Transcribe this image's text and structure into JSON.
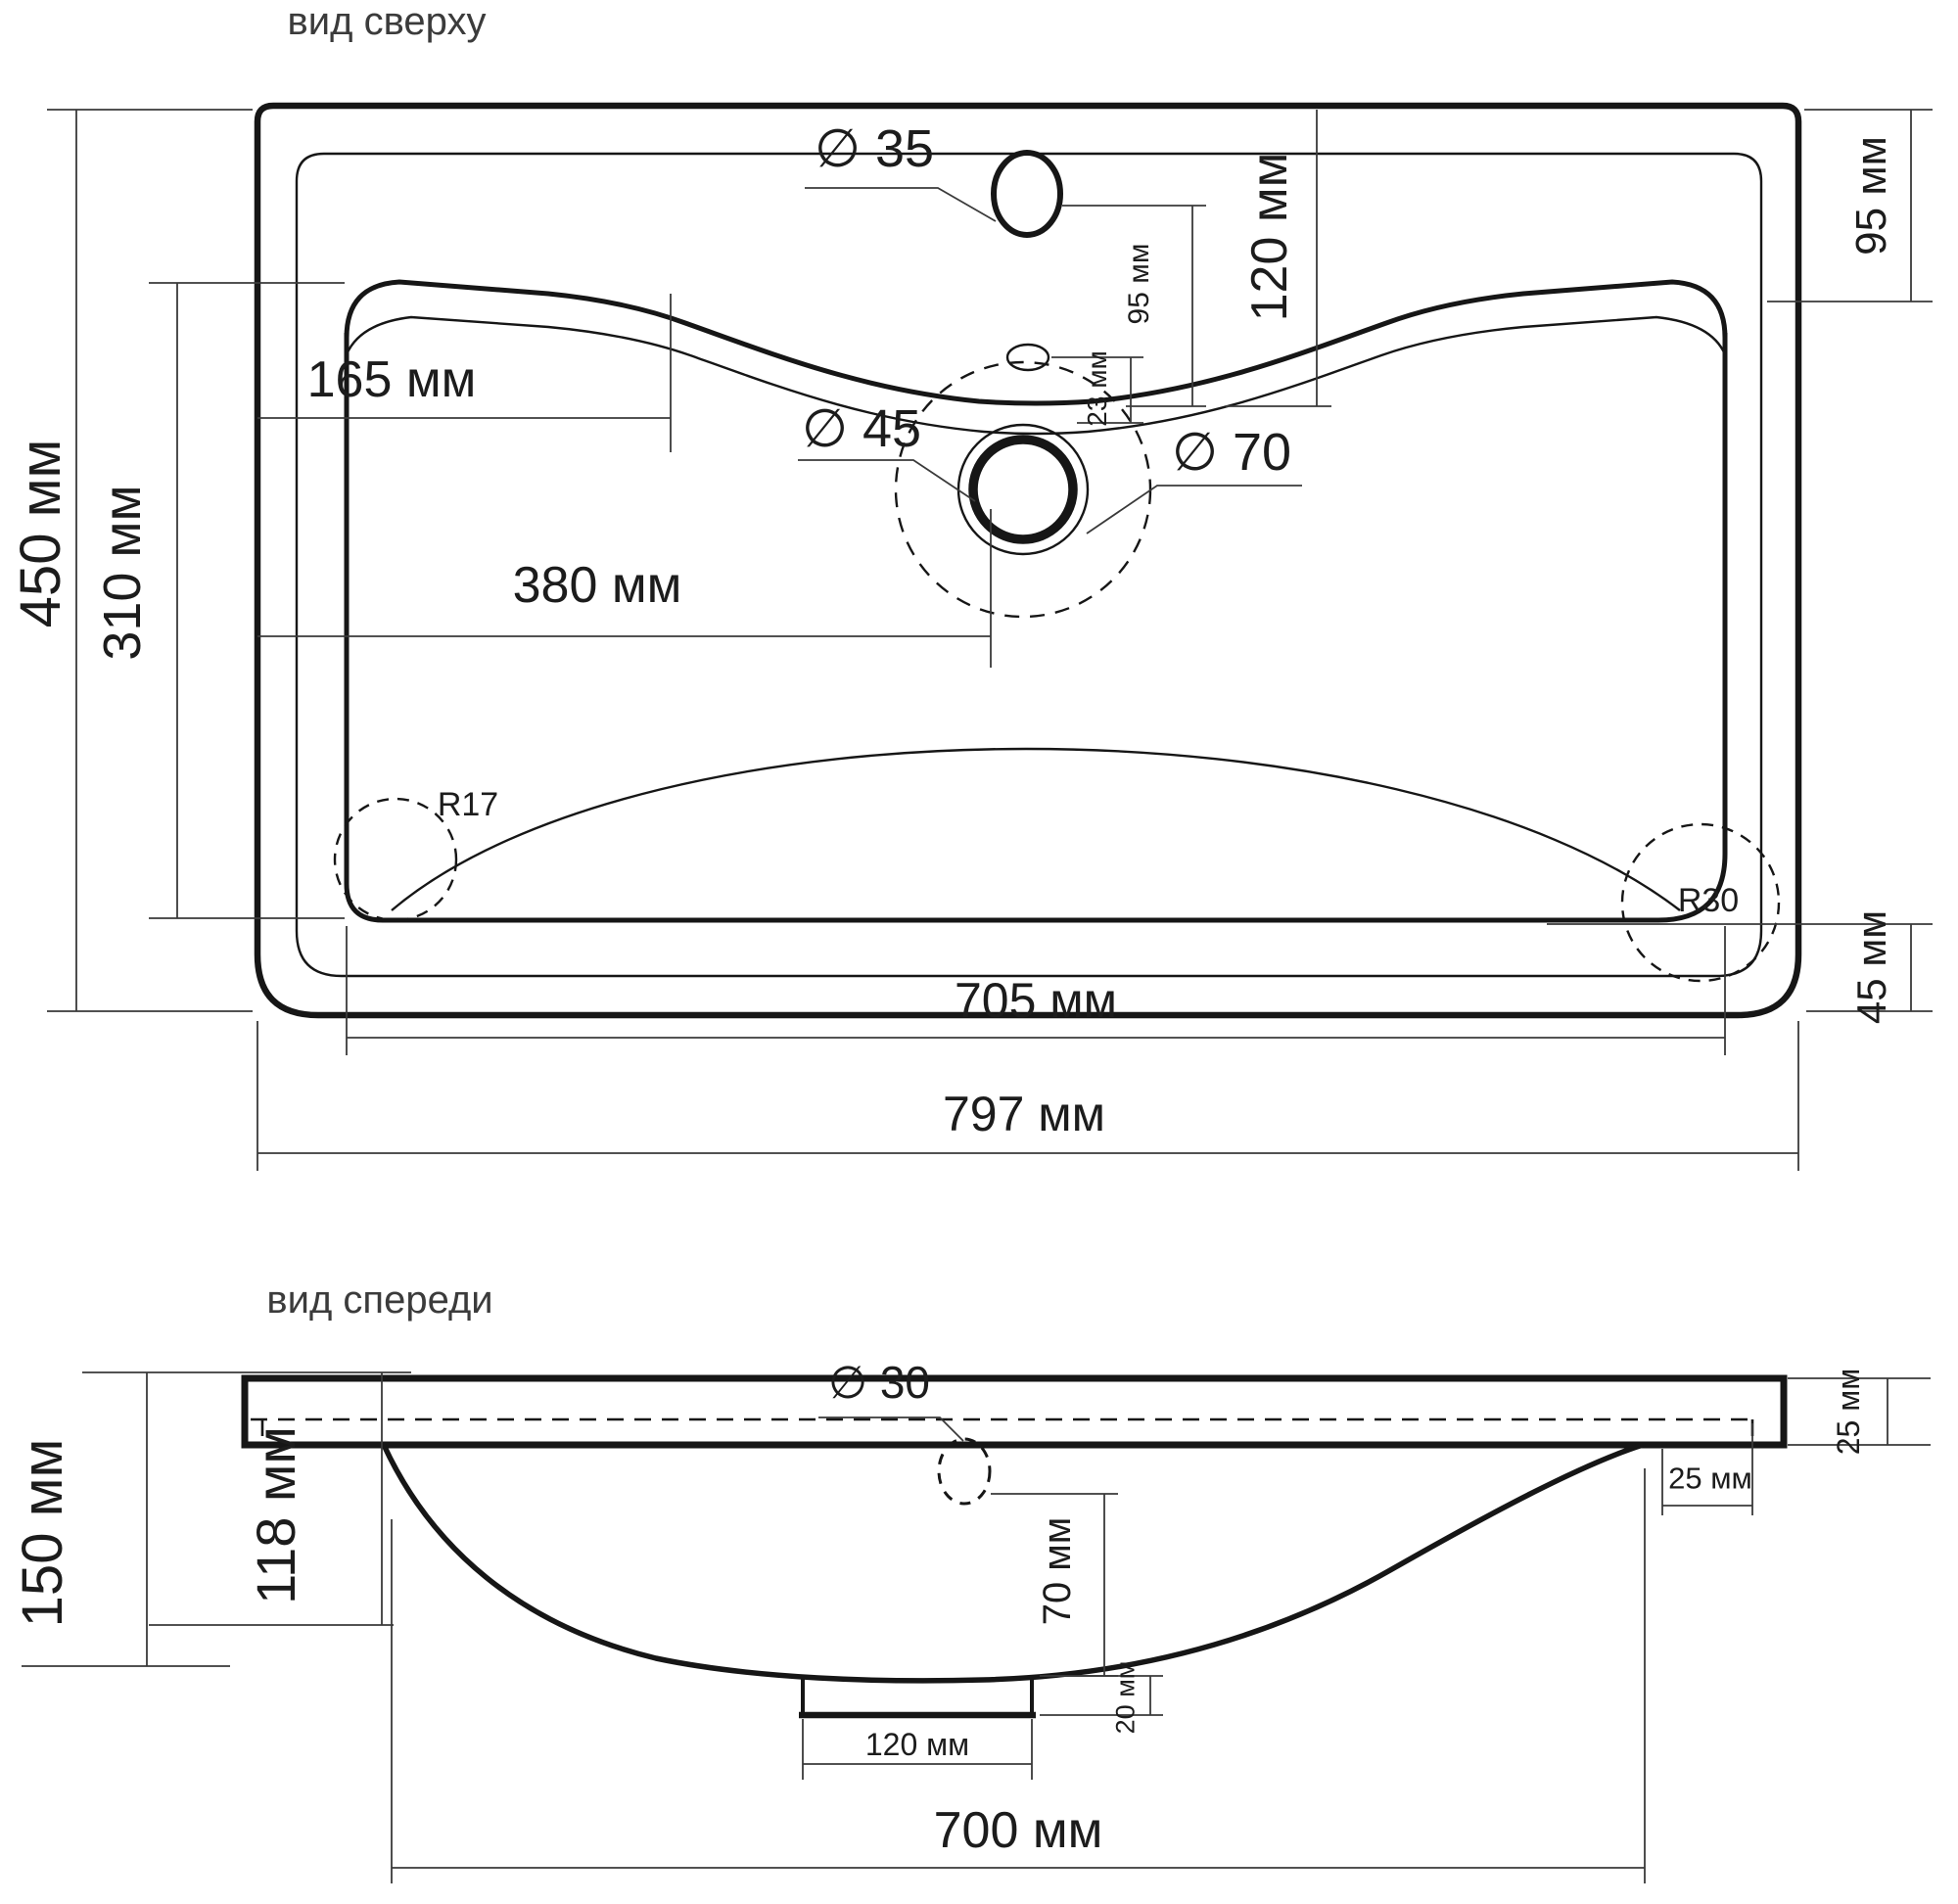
{
  "drawing": {
    "top_view": {
      "title": "вид сверху",
      "labels": {
        "overall_width": "797 мм",
        "basin_width": "705 мм",
        "overall_depth": "450 мм",
        "basin_depth": "310 мм",
        "left_ledge_width": "165 мм",
        "drain_center_offset": "380 мм",
        "faucet_hole_dia": "∅ 35",
        "drain_hole_dia": "∅ 45",
        "drain_recess_dia": "∅ 70",
        "faucet_to_basin_gap": "95 мм",
        "overflow_offset": "23 мм",
        "deck_depth": "120 мм",
        "right_ledge_depth": "95 мм",
        "left_corner_radius": "R17",
        "right_corner_radius": "R30",
        "rim_bottom_gap": "45 мм"
      }
    },
    "front_view": {
      "title": "вид спереди",
      "labels": {
        "overall_height": "150 мм",
        "bowl_depth": "118 мм",
        "overflow_hole_dia": "∅ 30",
        "slab_thickness": "25 мм",
        "edge_inset": "25 мм",
        "drain_zone_height": "70 мм",
        "stub_height": "20 мм",
        "stub_width": "120 мм",
        "bowl_width": "700 мм"
      }
    }
  }
}
